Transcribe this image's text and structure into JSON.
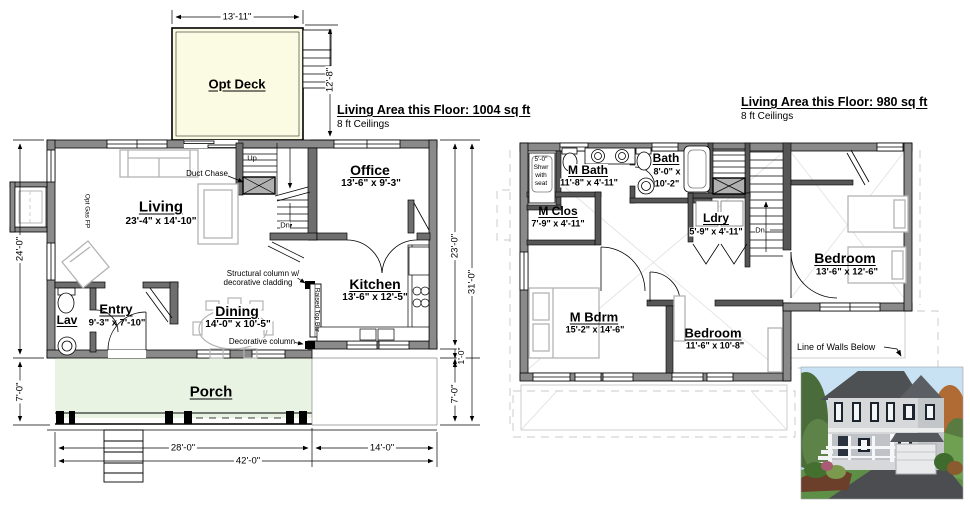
{
  "sheet": {
    "description": "Two-story house floor plan drawing with 3D rendering"
  },
  "floor1": {
    "area_label": "Living Area this Floor: 1004 sq ft",
    "ceilings": "8 ft Ceilings",
    "rooms": {
      "deck": {
        "name": "Opt Deck"
      },
      "living": {
        "name": "Living",
        "size": "23'-4\" x 14'-10\""
      },
      "office": {
        "name": "Office",
        "size": "13'-6\" x 9'-3\""
      },
      "kitchen": {
        "name": "Kitchen",
        "size": "13'-6\" x 12'-5\""
      },
      "dining": {
        "name": "Dining",
        "size": "14'-0\" x 10'-5\""
      },
      "entry": {
        "name": "Entry",
        "size": "9'-3\" x 7'-10\""
      },
      "lav": {
        "name": "Lav"
      },
      "porch": {
        "name": "Porch"
      }
    },
    "annotations": {
      "duct_chase": "Duct Chase",
      "up": "Up",
      "dn": "Dn",
      "opt_gas_fp": "Opt Gas FP",
      "structural_column_line1": "Structural column w/",
      "structural_column_line2": "decorative cladding",
      "decorative_column": "Decorative column",
      "raised_top_bar": "Raised Top Bar"
    },
    "dims": {
      "deck_width": "13'-11\"",
      "deck_depth": "12'-8\"",
      "left_main": "24'-0\"",
      "left_porch": "7'-0\"",
      "right_main": "23'-0\"",
      "right_total": "31'-0\"",
      "right_offset": "1'-0\"",
      "right_porch": "7'-0\"",
      "bottom_left": "28'-0\"",
      "bottom_right": "14'-0\"",
      "bottom_total": "42'-0\""
    }
  },
  "floor2": {
    "area_label": "Living Area this Floor: 980 sq ft",
    "ceilings": "8 ft Ceilings",
    "rooms": {
      "mbath": {
        "name": "M Bath",
        "size": "11'-8\" x 4'-11\""
      },
      "bath": {
        "name": "Bath",
        "size_line1": "8'-0\" x",
        "size_line2": "10'-2\""
      },
      "mclos": {
        "name": "M Clos",
        "size": "7'-9\" x 4'-11\""
      },
      "ldry": {
        "name": "Ldry",
        "size": "5'-9\" x 4'-11\""
      },
      "mbdrm": {
        "name": "M Bdrm",
        "size": "15'-2\" x 14'-6\""
      },
      "bedroom_mid": {
        "name": "Bedroom",
        "size": "11'-6\" x 10'-8\""
      },
      "bedroom_right": {
        "name": "Bedroom",
        "size": "13'-6\" x 12'-6\""
      }
    },
    "annotations": {
      "shower_line1": "5'-0\"",
      "shower_line2": "Shwr",
      "shower_line3": "with",
      "shower_line4": "seat",
      "dn": "Dn",
      "line_of_walls_below": "Line of Walls Below"
    }
  },
  "colors": {
    "deck_fill": "#fbfae3",
    "porch_fill": "#e8f3e4",
    "wall_gray": "#8a8a8a",
    "light_line": "#c8c8c8"
  }
}
